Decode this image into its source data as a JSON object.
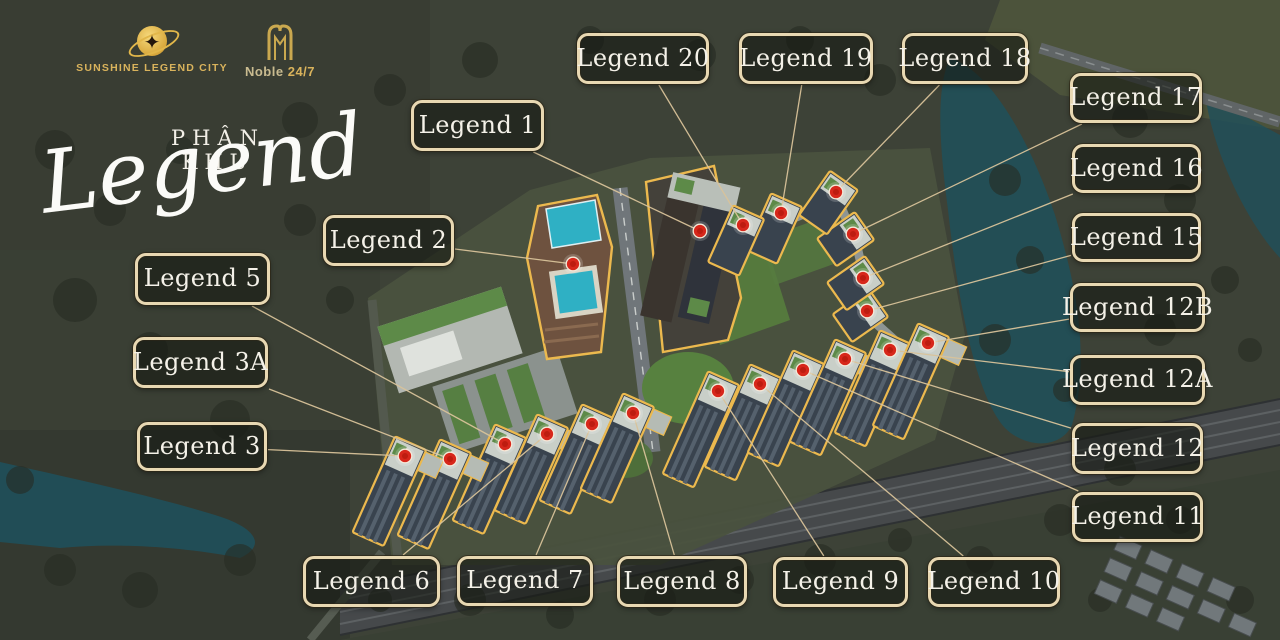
{
  "branding": {
    "sunshine_name": "SUNSHINE LEGEND CITY",
    "noble_name_word": "Noble",
    "noble_name_suffix": "24/7",
    "zone_prefix": "PHÂN KHU",
    "zone_script": "Legend"
  },
  "map": {
    "colors": {
      "marker": "#d7271b",
      "building_outline": "#ecb94e",
      "connector": "#d9c39a",
      "label_border": "#e8d8b2",
      "water": "#1f505b"
    },
    "labels": [
      {
        "text": "Legend 1",
        "x": 411,
        "y": 100,
        "w": 133,
        "h": 51,
        "tx": 700,
        "ty": 231,
        "b": false,
        "rot": 24,
        "len": 0
      },
      {
        "text": "Legend 2",
        "x": 323,
        "y": 215,
        "w": 131,
        "h": 51,
        "tx": 573,
        "ty": 264,
        "b": false,
        "rot": 24,
        "len": 0
      },
      {
        "text": "Legend 5",
        "x": 135,
        "y": 253,
        "w": 135,
        "h": 52,
        "tx": 505,
        "ty": 444,
        "b": true,
        "rot": 24,
        "len": 105
      },
      {
        "text": "Legend 3A",
        "x": 133,
        "y": 337,
        "w": 135,
        "h": 51,
        "tx": 450,
        "ty": 459,
        "b": true,
        "rot": 24,
        "len": 105
      },
      {
        "text": "Legend 3",
        "x": 137,
        "y": 422,
        "w": 130,
        "h": 49,
        "tx": 405,
        "ty": 456,
        "b": true,
        "rot": 24,
        "len": 105
      },
      {
        "text": "Legend 6",
        "x": 303,
        "y": 556,
        "w": 137,
        "h": 51,
        "tx": 547,
        "ty": 434,
        "b": true,
        "rot": 24,
        "len": 105
      },
      {
        "text": "Legend 7",
        "x": 457,
        "y": 556,
        "w": 136,
        "h": 50,
        "tx": 592,
        "ty": 424,
        "b": true,
        "rot": 24,
        "len": 105
      },
      {
        "text": "Legend 8",
        "x": 617,
        "y": 556,
        "w": 130,
        "h": 51,
        "tx": 633,
        "ty": 413,
        "b": true,
        "rot": 24,
        "len": 105
      },
      {
        "text": "Legend 9",
        "x": 773,
        "y": 557,
        "w": 135,
        "h": 50,
        "tx": 718,
        "ty": 391,
        "b": true,
        "rot": 24,
        "len": 112
      },
      {
        "text": "Legend 10",
        "x": 928,
        "y": 557,
        "w": 132,
        "h": 50,
        "tx": 760,
        "ty": 384,
        "b": true,
        "rot": 24,
        "len": 112
      },
      {
        "text": "Legend 11",
        "x": 1072,
        "y": 492,
        "w": 131,
        "h": 50,
        "tx": 803,
        "ty": 370,
        "b": true,
        "rot": 24,
        "len": 112
      },
      {
        "text": "Legend 12",
        "x": 1072,
        "y": 423,
        "w": 131,
        "h": 51,
        "tx": 845,
        "ty": 359,
        "b": true,
        "rot": 24,
        "len": 112
      },
      {
        "text": "Legend 12A",
        "x": 1070,
        "y": 355,
        "w": 135,
        "h": 50,
        "tx": 890,
        "ty": 350,
        "b": true,
        "rot": 24,
        "len": 112
      },
      {
        "text": "Legend 12B",
        "x": 1070,
        "y": 283,
        "w": 135,
        "h": 49,
        "tx": 928,
        "ty": 343,
        "b": true,
        "rot": 24,
        "len": 112
      },
      {
        "text": "Legend 15",
        "x": 1072,
        "y": 213,
        "w": 129,
        "h": 49,
        "tx": 867,
        "ty": 311,
        "b": true,
        "rot": 55,
        "len": 44
      },
      {
        "text": "Legend 16",
        "x": 1072,
        "y": 144,
        "w": 129,
        "h": 49,
        "tx": 863,
        "ty": 278,
        "b": true,
        "rot": 55,
        "len": 46
      },
      {
        "text": "Legend 17",
        "x": 1070,
        "y": 73,
        "w": 132,
        "h": 50,
        "tx": 853,
        "ty": 234,
        "b": true,
        "rot": 55,
        "len": 46
      },
      {
        "text": "Legend 18",
        "x": 902,
        "y": 33,
        "w": 126,
        "h": 51,
        "tx": 836,
        "ty": 192,
        "b": true,
        "rot": 35,
        "len": 54
      },
      {
        "text": "Legend 19",
        "x": 739,
        "y": 33,
        "w": 134,
        "h": 51,
        "tx": 781,
        "ty": 213,
        "b": true,
        "rot": 24,
        "len": 62
      },
      {
        "text": "Legend 20",
        "x": 577,
        "y": 33,
        "w": 132,
        "h": 51,
        "tx": 743,
        "ty": 225,
        "b": true,
        "rot": 24,
        "len": 62
      }
    ]
  }
}
